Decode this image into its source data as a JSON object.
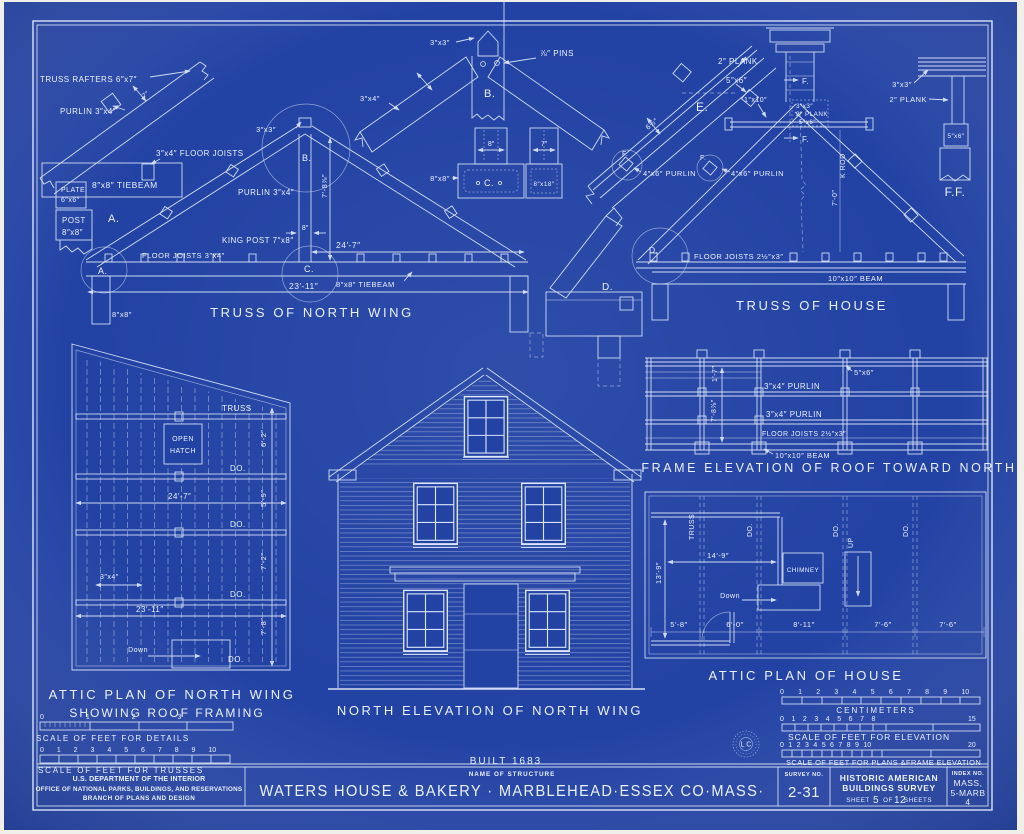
{
  "palette": {
    "paper": "#f0efe9",
    "blueprint": "#2242a4",
    "ink": "#eaf0fd"
  },
  "rafter_detail": {
    "truss_rafters": "TRUSS RAFTERS 6″x7″",
    "purlin": "PURLIN 3″x4″",
    "dim_depth": "7″",
    "floor_joists": "3″x4″ FLOOR JOISTS",
    "tiebeam": "8″x8″ TIEBEAM",
    "plate1": "PLATE",
    "plate2": "6″x6″",
    "post1": "POST",
    "post2": "8″x8″",
    "label": "A."
  },
  "truss_north_wing": {
    "title": "TRUSS OF NORTH WING",
    "peak_size": "3″x3″",
    "detail_b": "B.",
    "detail_c": "C.",
    "detail_a": "A.",
    "purlin": "PURLIN 3″x4″",
    "king_post": "KING POST 7″x8″",
    "king_post_width": "8″",
    "height": "7′-8⅞″",
    "span_upper": "24′-7″",
    "span_lower": "23′-11″",
    "floor_joists": "FLOOR JOISTS 3″x4″",
    "tiebeam": "8″x8″ TIEBEAM",
    "post": "8″x8″"
  },
  "peak_detail_b": {
    "size": "3″x3″",
    "pins": "⅞″ PINS",
    "rafter": "3″x4″",
    "label": "B."
  },
  "joint_detail_c": {
    "dim8": "8″",
    "dim7": "7″",
    "tiebeam": "8″x8″",
    "label": "C.",
    "post": "8″x18″"
  },
  "eave_detail_e": {
    "plank": "2″ PLANK",
    "purlin_size": "5″x6″",
    "label": "E.",
    "rafter_width": "6½″",
    "purlin1": "4″x6″ PURLIN",
    "purlin2": "4″x6″ PURLIN",
    "f1": "F.",
    "f2": "F."
  },
  "truss_of_house": {
    "title": "TRUSS OF HOUSE",
    "collar": "1″x10″",
    "ridge_size": "3″x3″",
    "ridge_plank": "2″ PLANK",
    "ridge_purlin": "5″x6″",
    "f_upper": "F.",
    "f_lower": "F.",
    "king_rod": "K ROD",
    "king_rod_len": "7′-0″",
    "floor_joists": "FLOOR JOISTS 2½″x3″",
    "beam": "10″x10″ BEAM",
    "detail_d": "D."
  },
  "ridge_detail_ff": {
    "size": "3″x3″",
    "plank": "2″ PLANK",
    "purlin": "5″x6″",
    "label": "F.F."
  },
  "joint_detail_d": {
    "label": "D."
  },
  "attic_plan_nw": {
    "title1": "ATTIC PLAN OF NORTH WING",
    "title2": "SHOWING ROOF FRAMING",
    "truss": "TRUSS",
    "hatch1": "OPEN",
    "hatch2": "HATCH",
    "do": [
      "DO.",
      "DO.",
      "DO.",
      "DO."
    ],
    "dims": [
      "6′-2″",
      "5′-9″",
      "7′-2″",
      "7′-8″"
    ],
    "span_upper": "24′-7″",
    "span_lower": "23′-11″",
    "joist": "3″x4″",
    "down": "Down"
  },
  "elevation": {
    "title": "NORTH ELEVATION OF NORTH WING",
    "built": "BUILT 1683"
  },
  "frame_elevation": {
    "title": "FRAME ELEVATION OF ROOF TOWARD NORTH",
    "post": "5″x6″",
    "purlin1": "3″x4″ PURLIN",
    "purlin2": "3″x4″ PURLIN",
    "joists": "FLOOR JOISTS 2½″x3″",
    "beam": "10″x10″ BEAM",
    "dim1": "1′-7″",
    "dim2": "7′-8⅞″"
  },
  "attic_plan_house": {
    "title": "ATTIC PLAN OF HOUSE",
    "truss": "TRUSS",
    "do": [
      "DO.",
      "DO.",
      "DO."
    ],
    "chimney": "CHIMNEY",
    "down": "Down",
    "up": "UP",
    "width": "14′-9″",
    "depth": "13′-9″",
    "bays": [
      "5′-8″",
      "6′-0″",
      "8′-11″",
      "7′-6″",
      "7′-6″"
    ]
  },
  "scales": {
    "details": {
      "numbers": "0 1 2 3",
      "label": "SCALE OF FEET FOR DETAILS"
    },
    "trusses": {
      "numbers": "0 1 2 3 4 5 6 7 8 9 10",
      "label": "SCALE OF FEET FOR TRUSSES"
    },
    "centimeters": {
      "numbers": "0 1 2 3 4 5 6 7 8 9 10",
      "label": "CENTIMETERS"
    },
    "elevation": {
      "numbers": "0 1 2 3 4 5 6 7 8",
      "end": "15",
      "label": "SCALE OF FEET FOR ELEVATION"
    },
    "plans": {
      "numbers": "0 1 2 3 4 5 6 7 8 9 10",
      "end": "20",
      "label": "SCALE OF FEET FOR PLANS &FRAME ELEVATION"
    }
  },
  "stamp": {
    "text": "L C"
  },
  "title_block": {
    "agency1": "U.S. DEPARTMENT OF THE INTERIOR",
    "agency2": "OFFICE OF NATIONAL PARKS, BUILDINGS, AND RESERVATIONS",
    "agency3": "BRANCH OF PLANS AND DESIGN",
    "name_label": "NAME OF STRUCTURE",
    "name": "WATERS HOUSE & BAKERY · MARBLEHEAD·ESSEX CO·MASS·",
    "survey_label": "SURVEY NO.",
    "survey_no": "2-31",
    "habs1": "HISTORIC AMERICAN",
    "habs2": "BUILDINGS SURVEY",
    "sheet_word": "SHEET",
    "sheet_no": "5",
    "of_word": "OF",
    "sheet_total": "12",
    "sheets_word": "SHEETS",
    "index_label": "INDEX NO.",
    "index1": "MASS,",
    "index2": "5-MARB",
    "index3": "4"
  }
}
